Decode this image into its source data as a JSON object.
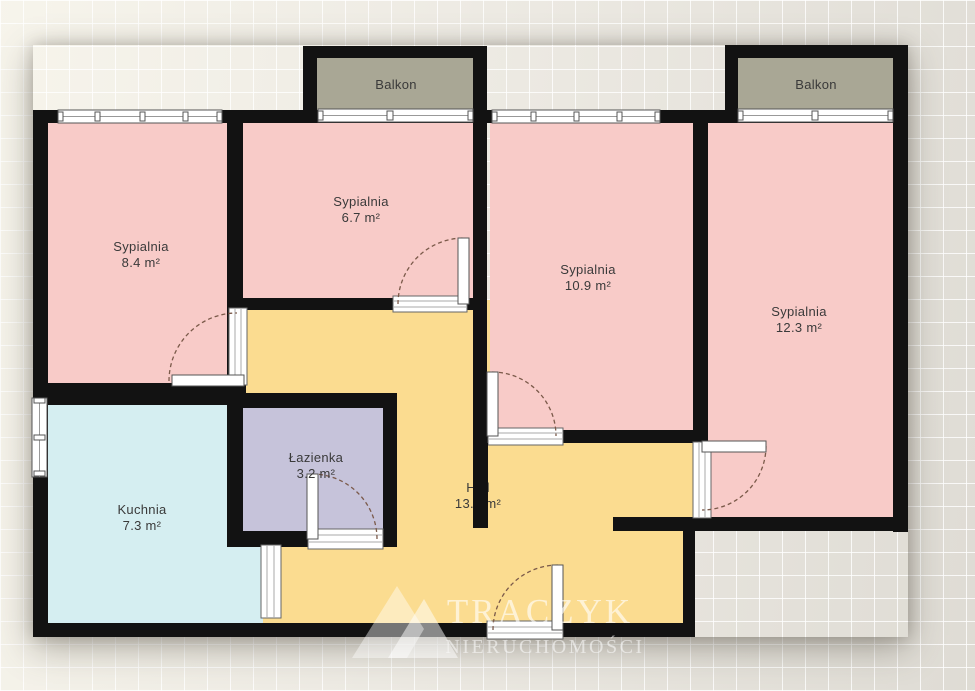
{
  "rooms": [
    {
      "id": "sypialnia-1",
      "name": "Sypialnia",
      "area": "8.4 m²",
      "fill": "#f8cbc8"
    },
    {
      "id": "sypialnia-2",
      "name": "Sypialnia",
      "area": "6.7 m²",
      "fill": "#f8cbc8"
    },
    {
      "id": "sypialnia-3",
      "name": "Sypialnia",
      "area": "10.9 m²",
      "fill": "#f8cbc8"
    },
    {
      "id": "sypialnia-4",
      "name": "Sypialnia",
      "area": "12.3 m²",
      "fill": "#f8cbc8"
    },
    {
      "id": "lazienka",
      "name": "Łazienka",
      "area": "3.2 m²",
      "fill": "#c6c3da"
    },
    {
      "id": "kuchnia",
      "name": "Kuchnia",
      "area": "7.3 m²",
      "fill": "#d5eef1"
    },
    {
      "id": "hall",
      "name": "Hall",
      "area": "13.1 m²",
      "fill": "#fbdc90"
    },
    {
      "id": "balkon-1",
      "name": "Balkon",
      "fill": "#a9a795"
    },
    {
      "id": "balkon-2",
      "name": "Balkon",
      "fill": "#a9a795"
    }
  ],
  "colors": {
    "wall": "#121212",
    "frame": "#ffffff",
    "door_arc": "#7b5a4a",
    "background": "#edeae3",
    "label_text": "#3a3a3a",
    "watermark": "rgba(255,255,255,0.6)"
  },
  "watermark": {
    "brand": "TRACZYK",
    "subtitle": "NIERUCHOMOŚCI"
  }
}
